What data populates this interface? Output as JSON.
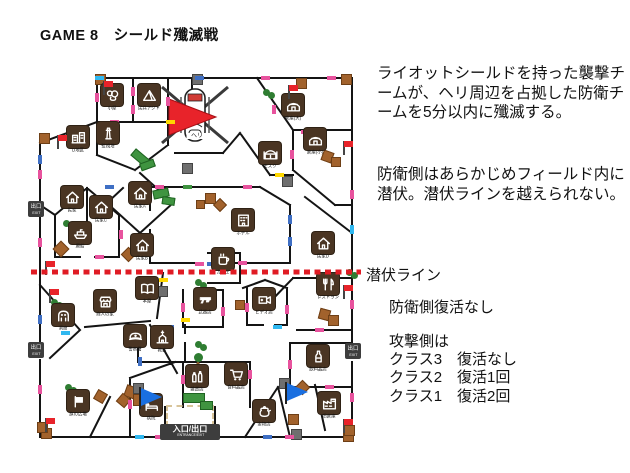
{
  "title": "GAME 8　シールド殲滅戦",
  "rules": {
    "p1": "ライオットシールドを持った襲撃チームが、ヘリ周辺を占拠した防衛チームを5分以内に殲滅する。",
    "p2": "防衛側はあらかじめフィールド内に潜伏。潜伏ラインを越えられない。",
    "line_label": "潜伏ライン",
    "defense_rule": "防衛側復活なし",
    "attack_header": "攻撃側は",
    "attack_rules": [
      "クラス3　復活なし",
      "クラス2　復活1回",
      "クラス1　復活2回"
    ]
  },
  "colors": {
    "hide_line_red": "#e01b24",
    "flag_red": "#e8232a",
    "pennant_blue": "#1a6fe0",
    "icon_brown": "#4a3523",
    "crate_brown": "#a2622c",
    "bush_green": "#2f7d32",
    "wall_black": "#141414",
    "tick_pink": "#e8539e",
    "tick_blue": "#3f6fc4",
    "tick_yellow": "#ffd800",
    "tick_cyan": "#30b8f0"
  },
  "map": {
    "heli_label": "ヘリ",
    "exit": {
      "jp": "出口",
      "en": "EXIT"
    },
    "entrance": {
      "jp": "入口/出口",
      "en": "ENTRANCE/EXIT"
    },
    "exits_pos": [
      [
        -7,
        126
      ],
      [
        -7,
        267
      ],
      [
        310,
        268
      ]
    ],
    "entrance_pos": [
      125,
      349
    ],
    "icons": [
      {
        "x": 77,
        "y": 20,
        "glyph": "blob",
        "label": "小屋"
      },
      {
        "x": 114,
        "y": 20,
        "glyph": "tent",
        "label": "民兵アジト"
      },
      {
        "x": 73,
        "y": 58,
        "glyph": "tower",
        "label": "監視塔"
      },
      {
        "x": 43,
        "y": 62,
        "glyph": "city",
        "label": "D地区"
      },
      {
        "x": 37,
        "y": 122,
        "glyph": "house",
        "label": "民家"
      },
      {
        "x": 66,
        "y": 132,
        "glyph": "house",
        "label": "民家C"
      },
      {
        "x": 105,
        "y": 118,
        "glyph": "house",
        "label": "民家A"
      },
      {
        "x": 258,
        "y": 30,
        "glyph": "warehouse",
        "label": "倉庫(大)"
      },
      {
        "x": 280,
        "y": 64,
        "glyph": "warehouse",
        "label": "倉庫(小)"
      },
      {
        "x": 235,
        "y": 78,
        "glyph": "mosque",
        "label": "モスク"
      },
      {
        "x": 208,
        "y": 145,
        "glyph": "hotel",
        "label": "ホテル"
      },
      {
        "x": 288,
        "y": 168,
        "glyph": "house",
        "label": "民家D"
      },
      {
        "x": 45,
        "y": 158,
        "glyph": "ship",
        "label": "廃船"
      },
      {
        "x": 107,
        "y": 170,
        "glyph": "house",
        "label": "民家B"
      },
      {
        "x": 188,
        "y": 184,
        "glyph": "cup",
        "label": "カフェ"
      },
      {
        "x": 112,
        "y": 213,
        "glyph": "book",
        "label": "本屋"
      },
      {
        "x": 70,
        "y": 226,
        "glyph": "shop",
        "label": "商人の家"
      },
      {
        "x": 28,
        "y": 240,
        "glyph": "ghost",
        "label": "洞窟"
      },
      {
        "x": 100,
        "y": 261,
        "glyph": "police",
        "label": "警察署"
      },
      {
        "x": 170,
        "y": 224,
        "glyph": "gun",
        "label": "武器店"
      },
      {
        "x": 127,
        "y": 262,
        "glyph": "church",
        "label": "教会"
      },
      {
        "x": 229,
        "y": 224,
        "glyph": "camera",
        "label": "ビデオ店"
      },
      {
        "x": 293,
        "y": 209,
        "glyph": "cutlery",
        "label": "レストラン"
      },
      {
        "x": 283,
        "y": 281,
        "glyph": "bottle",
        "label": "飲料品店"
      },
      {
        "x": 162,
        "y": 301,
        "glyph": "bottles",
        "label": "雑貨店"
      },
      {
        "x": 201,
        "y": 299,
        "glyph": "cart",
        "label": "食料品店"
      },
      {
        "x": 116,
        "y": 330,
        "glyph": "bed",
        "label": "病院"
      },
      {
        "x": 43,
        "y": 326,
        "glyph": "flagsq",
        "label": "旗の広場"
      },
      {
        "x": 229,
        "y": 336,
        "glyph": "teapot",
        "label": "金物店"
      },
      {
        "x": 294,
        "y": 328,
        "glyph": "factory",
        "label": "旧倉庫"
      }
    ],
    "flags_red": [
      [
        68,
        6
      ],
      [
        22,
        60
      ],
      [
        253,
        10
      ],
      [
        308,
        66
      ],
      [
        10,
        186
      ],
      [
        14,
        214
      ],
      [
        308,
        210
      ],
      [
        10,
        343
      ],
      [
        308,
        344
      ]
    ],
    "pennants_blue": [
      [
        104,
        312
      ],
      [
        250,
        307
      ]
    ],
    "bushes": [
      [
        228,
        14
      ],
      [
        28,
        145
      ],
      [
        16,
        224
      ],
      [
        30,
        309
      ],
      [
        311,
        194
      ],
      [
        160,
        204
      ],
      [
        160,
        266
      ]
    ],
    "tree": [
      157,
      278
    ],
    "crates": [
      [
        170,
        118,
        9,
        0
      ],
      [
        180,
        125,
        8,
        45
      ],
      [
        161,
        125,
        7,
        0
      ],
      [
        248,
        22,
        9,
        0
      ],
      [
        287,
        76,
        9,
        20
      ],
      [
        296,
        82,
        8,
        0
      ],
      [
        20,
        168,
        10,
        45
      ],
      [
        88,
        174,
        9,
        45
      ],
      [
        200,
        225,
        8,
        0
      ],
      [
        284,
        234,
        9,
        15
      ],
      [
        293,
        240,
        9,
        0
      ],
      [
        262,
        307,
        9,
        45
      ],
      [
        90,
        311,
        10,
        20
      ],
      [
        98,
        319,
        10,
        0
      ],
      [
        83,
        320,
        9,
        40
      ],
      [
        60,
        316,
        9,
        30
      ],
      [
        253,
        339,
        9,
        0
      ],
      [
        308,
        356,
        9,
        0
      ],
      [
        6,
        353,
        9,
        0
      ]
    ],
    "squares": [
      [
        157,
        -1,
        "gray"
      ],
      [
        147,
        88,
        "gray"
      ],
      [
        247,
        101,
        "gray"
      ],
      [
        122,
        211,
        "gray"
      ],
      [
        127,
        354,
        "gray"
      ],
      [
        256,
        354,
        "gray"
      ],
      [
        98,
        308,
        "gray"
      ],
      [
        244,
        303,
        "gray"
      ],
      [
        60,
        -1,
        "brown"
      ],
      [
        261,
        3,
        "brown"
      ],
      [
        306,
        -1,
        "brown"
      ],
      [
        4,
        58,
        "brown"
      ],
      [
        2,
        347,
        "brown"
      ],
      [
        309,
        350,
        "brown"
      ]
    ],
    "green_barriers": [
      [
        96,
        78,
        16,
        7,
        40
      ],
      [
        105,
        86,
        13,
        6,
        -20
      ],
      [
        118,
        114,
        14,
        7,
        -12
      ],
      [
        127,
        122,
        11,
        6,
        8
      ],
      [
        148,
        318,
        20,
        8,
        0
      ],
      [
        165,
        326,
        11,
        7,
        0
      ]
    ],
    "ticks": [
      [
        96,
        12,
        "p",
        "v"
      ],
      [
        96,
        30,
        "p",
        "v"
      ],
      [
        131,
        22,
        "p",
        "v"
      ],
      [
        75,
        45,
        "p",
        "h"
      ],
      [
        3,
        95,
        "p",
        "v"
      ],
      [
        3,
        163,
        "p",
        "v"
      ],
      [
        34,
        128,
        "p",
        "h"
      ],
      [
        84,
        155,
        "p",
        "v"
      ],
      [
        120,
        110,
        "p",
        "h"
      ],
      [
        208,
        110,
        "p",
        "h"
      ],
      [
        237,
        30,
        "p",
        "v"
      ],
      [
        255,
        75,
        "p",
        "v"
      ],
      [
        315,
        115,
        "p",
        "v"
      ],
      [
        315,
        225,
        "p",
        "v"
      ],
      [
        292,
        1,
        "p",
        "h"
      ],
      [
        266,
        55,
        "p",
        "h"
      ],
      [
        203,
        186,
        "p",
        "h"
      ],
      [
        146,
        228,
        "p",
        "v"
      ],
      [
        186,
        232,
        "p",
        "v"
      ],
      [
        101,
        262,
        "p",
        "v"
      ],
      [
        210,
        228,
        "p",
        "v"
      ],
      [
        250,
        230,
        "p",
        "v"
      ],
      [
        280,
        253,
        "p",
        "h"
      ],
      [
        253,
        285,
        "p",
        "v"
      ],
      [
        315,
        318,
        "p",
        "v"
      ],
      [
        213,
        295,
        "p",
        "v"
      ],
      [
        146,
        300,
        "p",
        "v"
      ],
      [
        93,
        325,
        "p",
        "v"
      ],
      [
        3,
        310,
        "p",
        "v"
      ],
      [
        60,
        180,
        "p",
        "h"
      ],
      [
        120,
        360,
        "p",
        "h"
      ],
      [
        250,
        360,
        "p",
        "h"
      ],
      [
        290,
        310,
        "p",
        "h"
      ],
      [
        226,
        1,
        "p",
        "h"
      ],
      [
        60,
        18,
        "p",
        "v"
      ],
      [
        160,
        187,
        "p",
        "h"
      ],
      [
        70,
        110,
        "b",
        "h"
      ],
      [
        3,
        240,
        "b",
        "v"
      ],
      [
        160,
        1,
        "b",
        "h"
      ],
      [
        172,
        187,
        "b",
        "h"
      ],
      [
        253,
        140,
        "b",
        "v"
      ],
      [
        103,
        282,
        "b",
        "v"
      ],
      [
        228,
        360,
        "b",
        "h"
      ],
      [
        130,
        250,
        "b",
        "h"
      ],
      [
        3,
        80,
        "b",
        "v"
      ],
      [
        296,
        200,
        "b",
        "h"
      ],
      [
        253,
        162,
        "b",
        "v"
      ],
      [
        131,
        45,
        "y",
        "h"
      ],
      [
        146,
        243,
        "y",
        "h"
      ],
      [
        124,
        203,
        "y",
        "h"
      ],
      [
        240,
        98,
        "y",
        "h"
      ],
      [
        172,
        360,
        "y",
        "h"
      ],
      [
        315,
        150,
        "c",
        "v"
      ],
      [
        100,
        360,
        "c",
        "h"
      ],
      [
        238,
        250,
        "c",
        "h"
      ],
      [
        26,
        256,
        "c",
        "h"
      ],
      [
        60,
        1,
        "c",
        "h"
      ],
      [
        148,
        110,
        "g",
        "h"
      ]
    ]
  }
}
